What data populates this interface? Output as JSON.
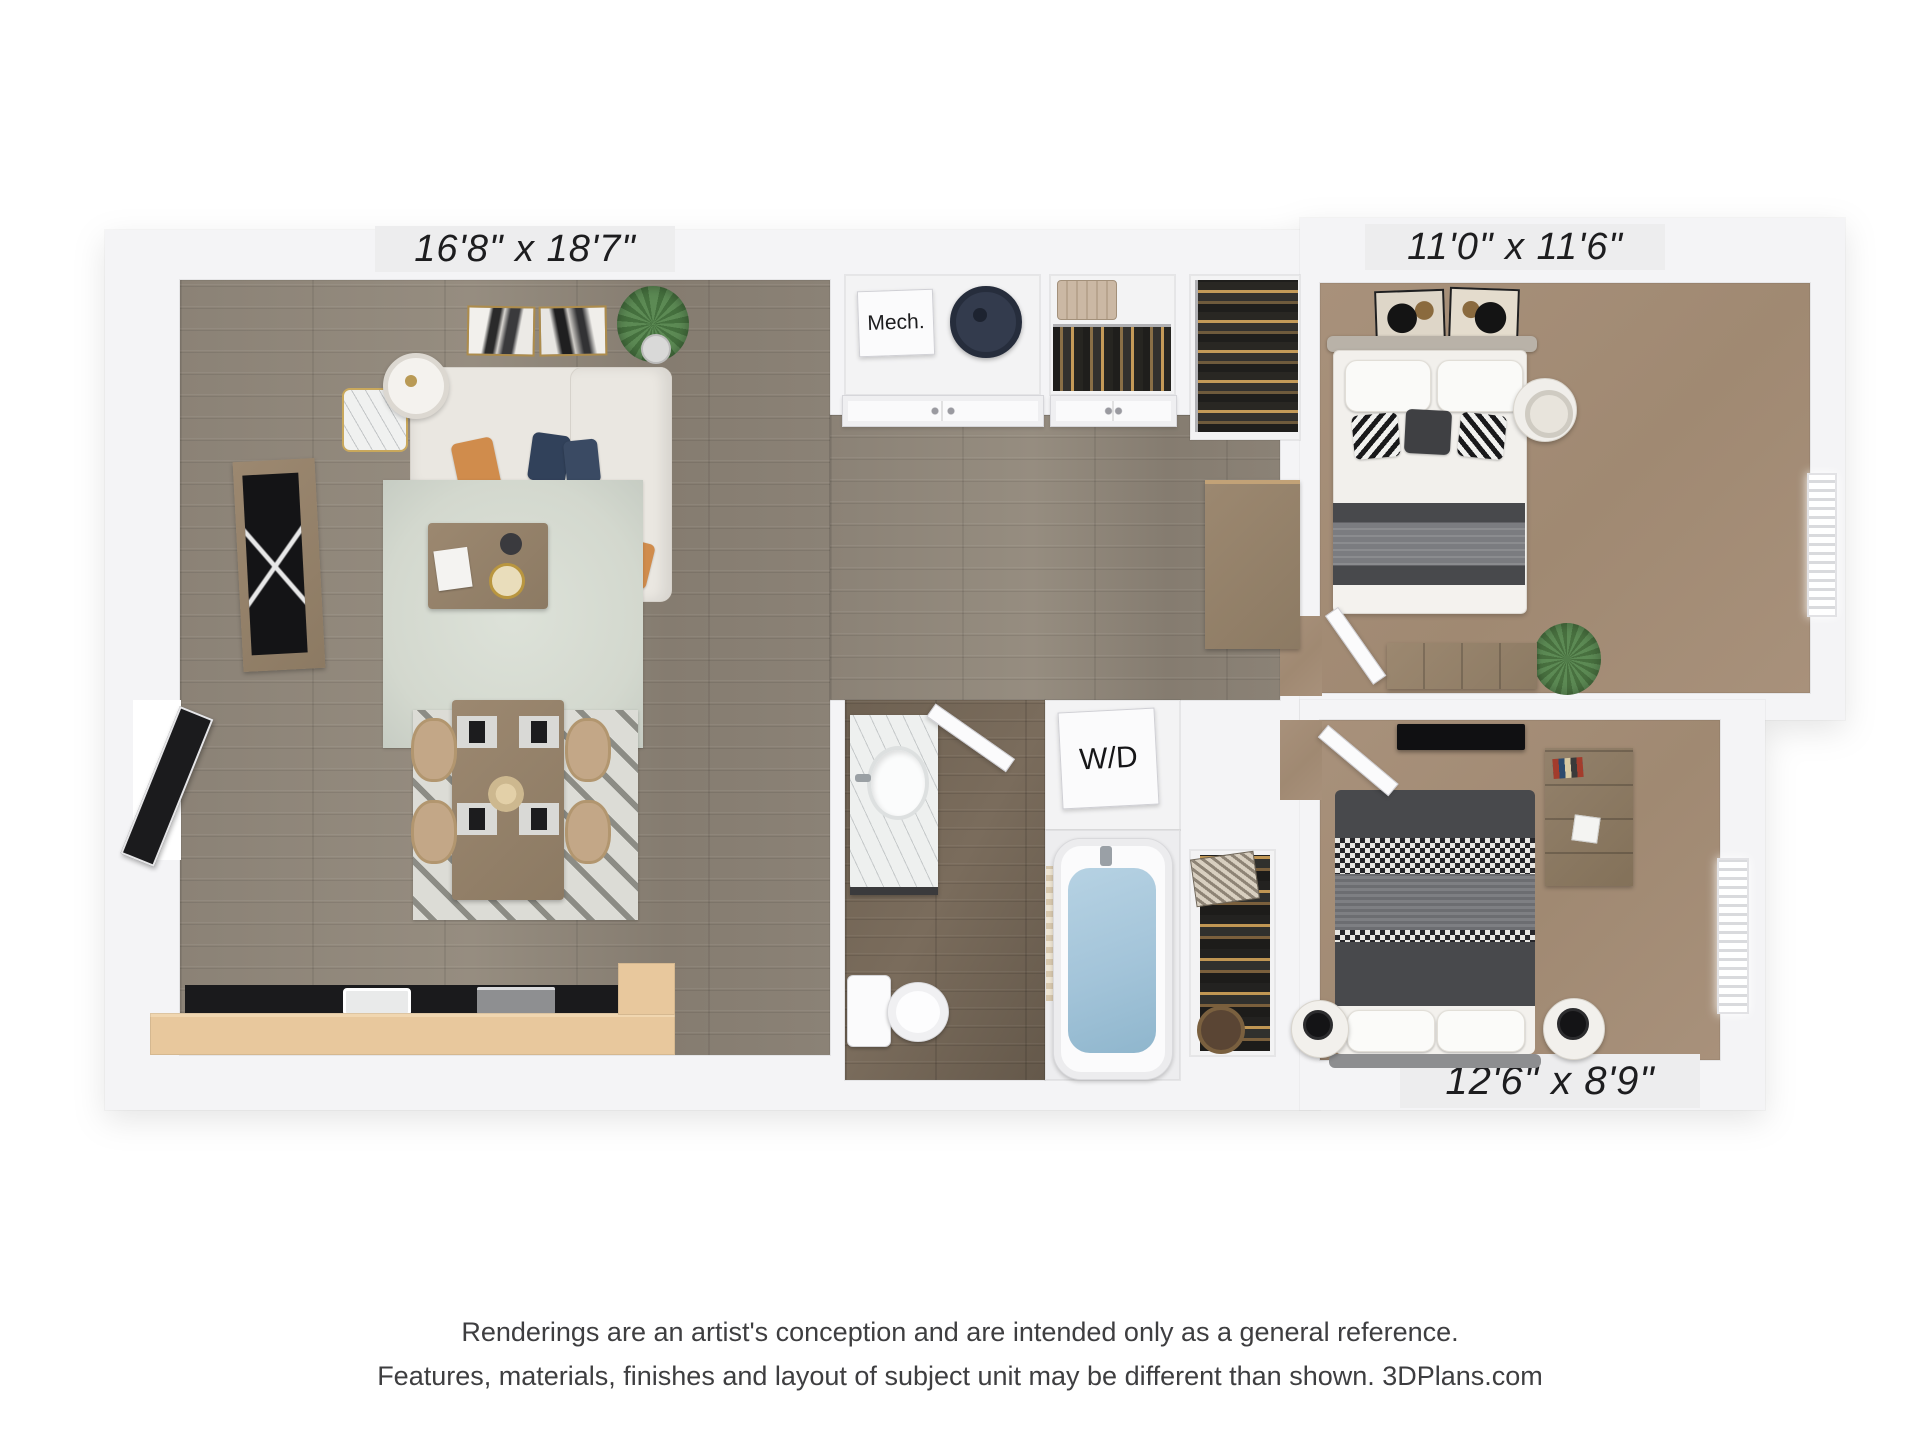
{
  "plan": {
    "rooms": {
      "living_dining": {
        "dimensions": "16'8\" x 18'7\""
      },
      "bedroom_top": {
        "dimensions": "11'0\" x 11'6\""
      },
      "bedroom_bottom": {
        "dimensions": "12'6\" x 8'9\""
      },
      "mech_closet": {
        "label": "Mech."
      },
      "laundry": {
        "label": "W/D"
      }
    }
  },
  "footer": {
    "disclaimer_line1": "Renderings are an artist's conception and are intended only as a general reference.",
    "disclaimer_line2": "Features, materials, finishes and layout of subject unit may be different than shown. 3DPlans.com"
  },
  "colors": {
    "wall": "#f4f4f6",
    "dim_chip": "#ededee",
    "text_dark": "#1d1d1f",
    "text_footer": "#3e3e40",
    "wood_floor_living": "#8b8276",
    "wood_floor_bath": "#6e6152",
    "carpet": "#a8917b",
    "closet_floor": "#f3f3f4",
    "kitchen_counter": "#1a1a1c",
    "kitchen_bar": "#e8c89d",
    "rug_living": "#d3d8ce",
    "sofa": "#eae7e1",
    "accent_orange": "#d08c4c",
    "accent_navy": "#31415a",
    "bed_dark_gray": "#48494c",
    "bed_mid_gray": "#7b7c80",
    "tub_water": "#a3c4d9",
    "furniture_wood": "#9c8870",
    "door_black": "#1b1b1d",
    "water_heater": "#333b4d"
  }
}
